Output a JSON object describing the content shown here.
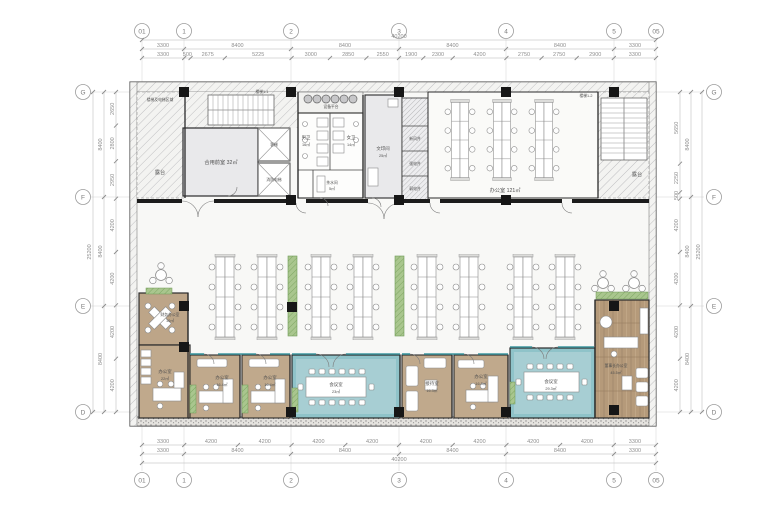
{
  "grid": {
    "top": [
      "01",
      "1",
      "2",
      "3",
      "4",
      "5",
      "05"
    ],
    "bottom": [
      "01",
      "1",
      "2",
      "3",
      "4",
      "5",
      "05"
    ],
    "left": [
      "G",
      "F",
      "E",
      "D"
    ],
    "right": [
      "G",
      "F",
      "E",
      "D"
    ]
  },
  "dims": {
    "top_total": "40200",
    "top_grid": [
      "3300",
      "8400",
      "8400",
      "8400",
      "8400",
      "3300"
    ],
    "top_detail": [
      "3300",
      "500",
      "2675",
      "5225",
      "3000",
      "2850",
      "2550",
      "1900",
      "2300",
      "4200",
      "2750",
      "2750",
      "2900",
      "3300"
    ],
    "bottom_total": "40200",
    "bottom_grid": [
      "3300",
      "8400",
      "8400",
      "8400",
      "8400",
      "3300"
    ],
    "bottom_detail": [
      "3300",
      "4200",
      "4200",
      "4200",
      "4200",
      "4200",
      "4200",
      "4200",
      "4200",
      "3300"
    ],
    "left_total": "25200",
    "left_grid": [
      "8400",
      "8400",
      "8400"
    ],
    "left_detail": [
      "2650",
      "2800",
      "2950",
      "4200",
      "4200",
      "4200",
      "4200"
    ],
    "right_total": "25200",
    "right_grid": [
      "8400",
      "8400",
      "8400"
    ],
    "right_detail": [
      "5650",
      "2250",
      "500",
      "4200",
      "4200",
      "4200",
      "4200"
    ]
  },
  "rooms": {
    "terrace_left": {
      "label": "露台"
    },
    "terrace_right": {
      "label": "露台"
    },
    "corner_note": {
      "label": "楼梯及电梯区域"
    },
    "stair1": {
      "label": "楼梯1-1"
    },
    "stair2": {
      "label": "楼梯1-2"
    },
    "shared_lobby": {
      "label": "合用前室 32㎡"
    },
    "elevator1": {
      "label": "客梯"
    },
    "elevator2": {
      "label": "消防电梯"
    },
    "equip": {
      "label": "设备平台"
    },
    "mens": {
      "name": "男卫",
      "area": "16㎡"
    },
    "womens": {
      "name": "女卫",
      "area": "14㎡"
    },
    "pantry": {
      "name": "茶水间",
      "area": "5㎡"
    },
    "print": {
      "name": "文印间",
      "area": "25㎡"
    },
    "shaft_fresh": {
      "label": "新风井"
    },
    "shaft_power": {
      "label": "强电井"
    },
    "shaft_elv": {
      "label": "弱电井"
    },
    "office_top": {
      "label": "办公室 121㎡"
    },
    "finance": {
      "name": "财务办公室",
      "area": "10㎡"
    },
    "office22": {
      "name": "办公室",
      "area": "22㎡"
    },
    "office164a": {
      "name": "办公室",
      "area": "16.4㎡"
    },
    "office164b": {
      "name": "办公室",
      "area": "16.4㎡"
    },
    "meeting1": {
      "name": "会议室",
      "area": "23㎡"
    },
    "reception": {
      "name": "接待室",
      "area": "16.3㎡"
    },
    "office163": {
      "name": "办公室",
      "area": "16.3㎡"
    },
    "meeting2": {
      "name": "会议室",
      "area": "29.3㎡"
    },
    "chairman": {
      "name": "董事长办公室",
      "area": "45.5㎡"
    }
  },
  "colors": {
    "teal": "#8fc3c9",
    "teal_light": "#a7ced3",
    "tan": "#c0a98c",
    "wood": "#b59a7a",
    "green": "#a9c68e",
    "gray_room": "#e9e9eb",
    "wall": "#1c1c1c"
  }
}
